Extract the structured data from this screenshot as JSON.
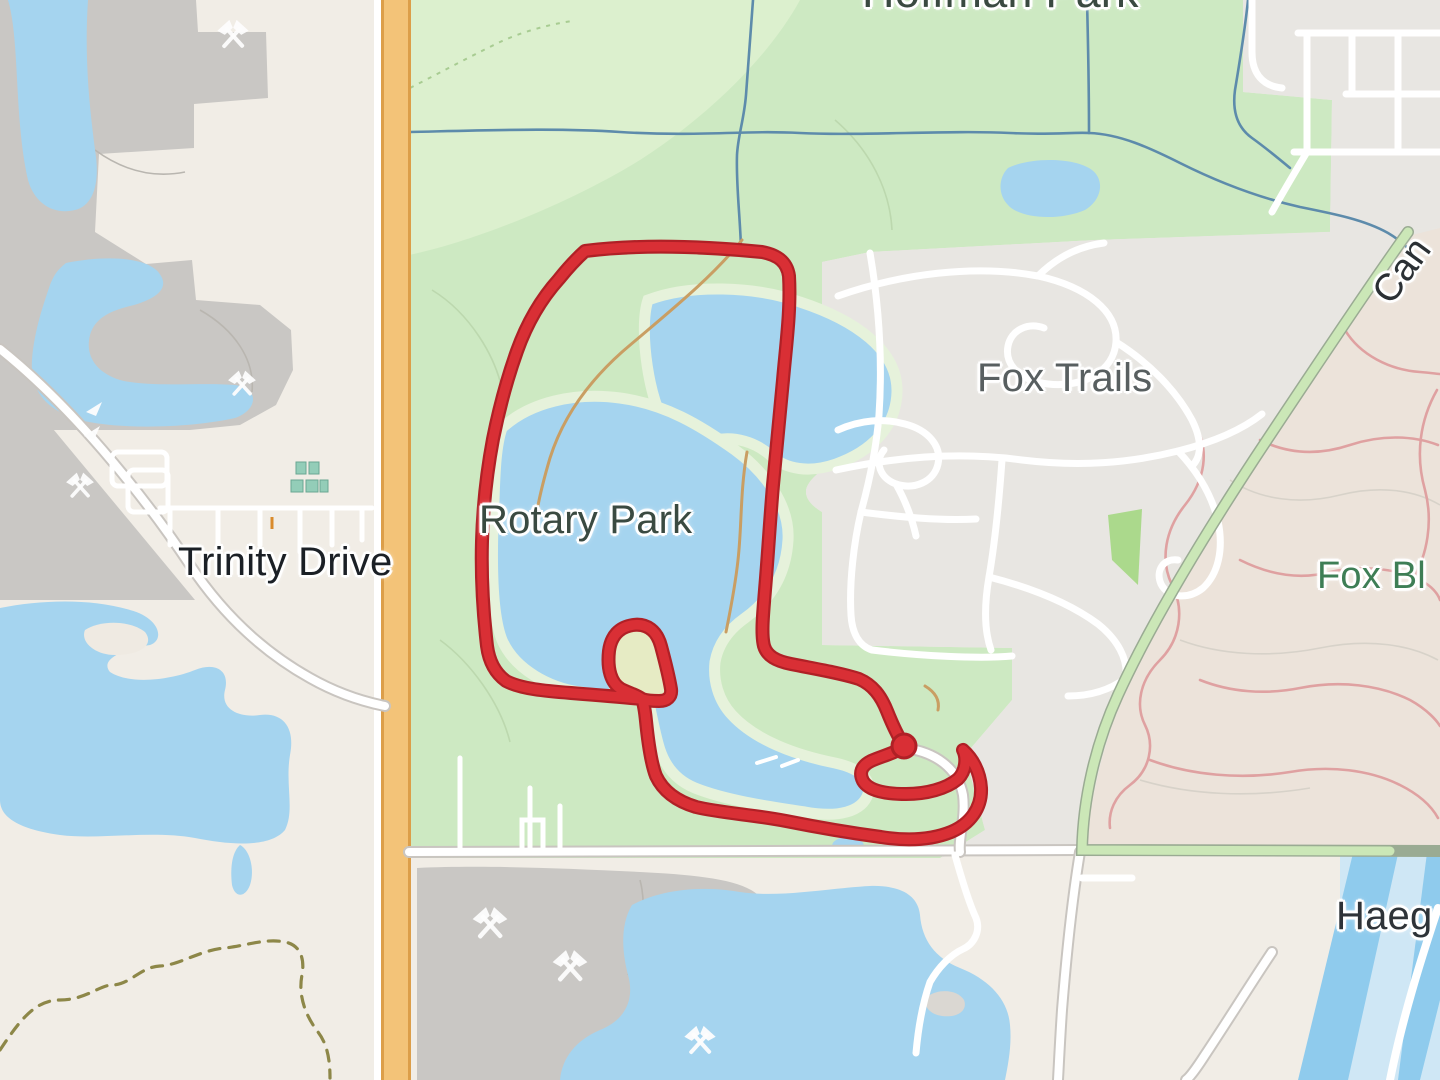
{
  "app": {
    "type": "map-view"
  },
  "map": {
    "labels": {
      "hoffman_park": "Hoffman Park",
      "fox_trails": "Fox Trails",
      "rotary_park": "Rotary Park",
      "trinity_drive": "Trinity Drive",
      "fox_bluff_partial": "Fox Bl",
      "haegers_partial": "Haeg",
      "cary_road_partial": "Can"
    },
    "route": {
      "kind": "gps-track-loop",
      "location": "Rotary Park",
      "stroke_color": "#d92f35",
      "outline_color": "#b02026",
      "has_endpoint_marker": true
    },
    "icons": {
      "mine_symbol": "crossed-hammers-icon",
      "mine_symbol_count": 6
    },
    "colors": {
      "base_beige": "#f1ede6",
      "water": "#a5d4ef",
      "water_light": "#cfe7f5",
      "river": "#8fcbed",
      "park_green": "#cde9c2",
      "park_green_light": "#dcf0ce",
      "park_shore": "#e6f2db",
      "residential_gray": "#e8e6e2",
      "industrial_gray": "#c9c7c4",
      "bluff_pink": "#ece3da",
      "road_orange": "#f3c378",
      "road_orange_casing": "#dc9e49",
      "road_white": "#ffffff",
      "road_casing": "#c9c5c0",
      "green_road": "#cbe7b7",
      "green_road_casing": "#9aab93",
      "stream_blue": "#5d8bab",
      "trail_tan": "#c99e63",
      "trail_pink": "#dfa1a1",
      "trail_olive": "#8d8748",
      "route_red": "#d92f35",
      "route_dark": "#b02026",
      "contour_gray": "#d7d2c9",
      "teal_building": "#93cdb8",
      "label_park_green": "#3a4a41",
      "label_city_gray": "#585f60",
      "label_road_dark": "#1b2026",
      "label_bluff_green": "#3e7e55"
    }
  }
}
